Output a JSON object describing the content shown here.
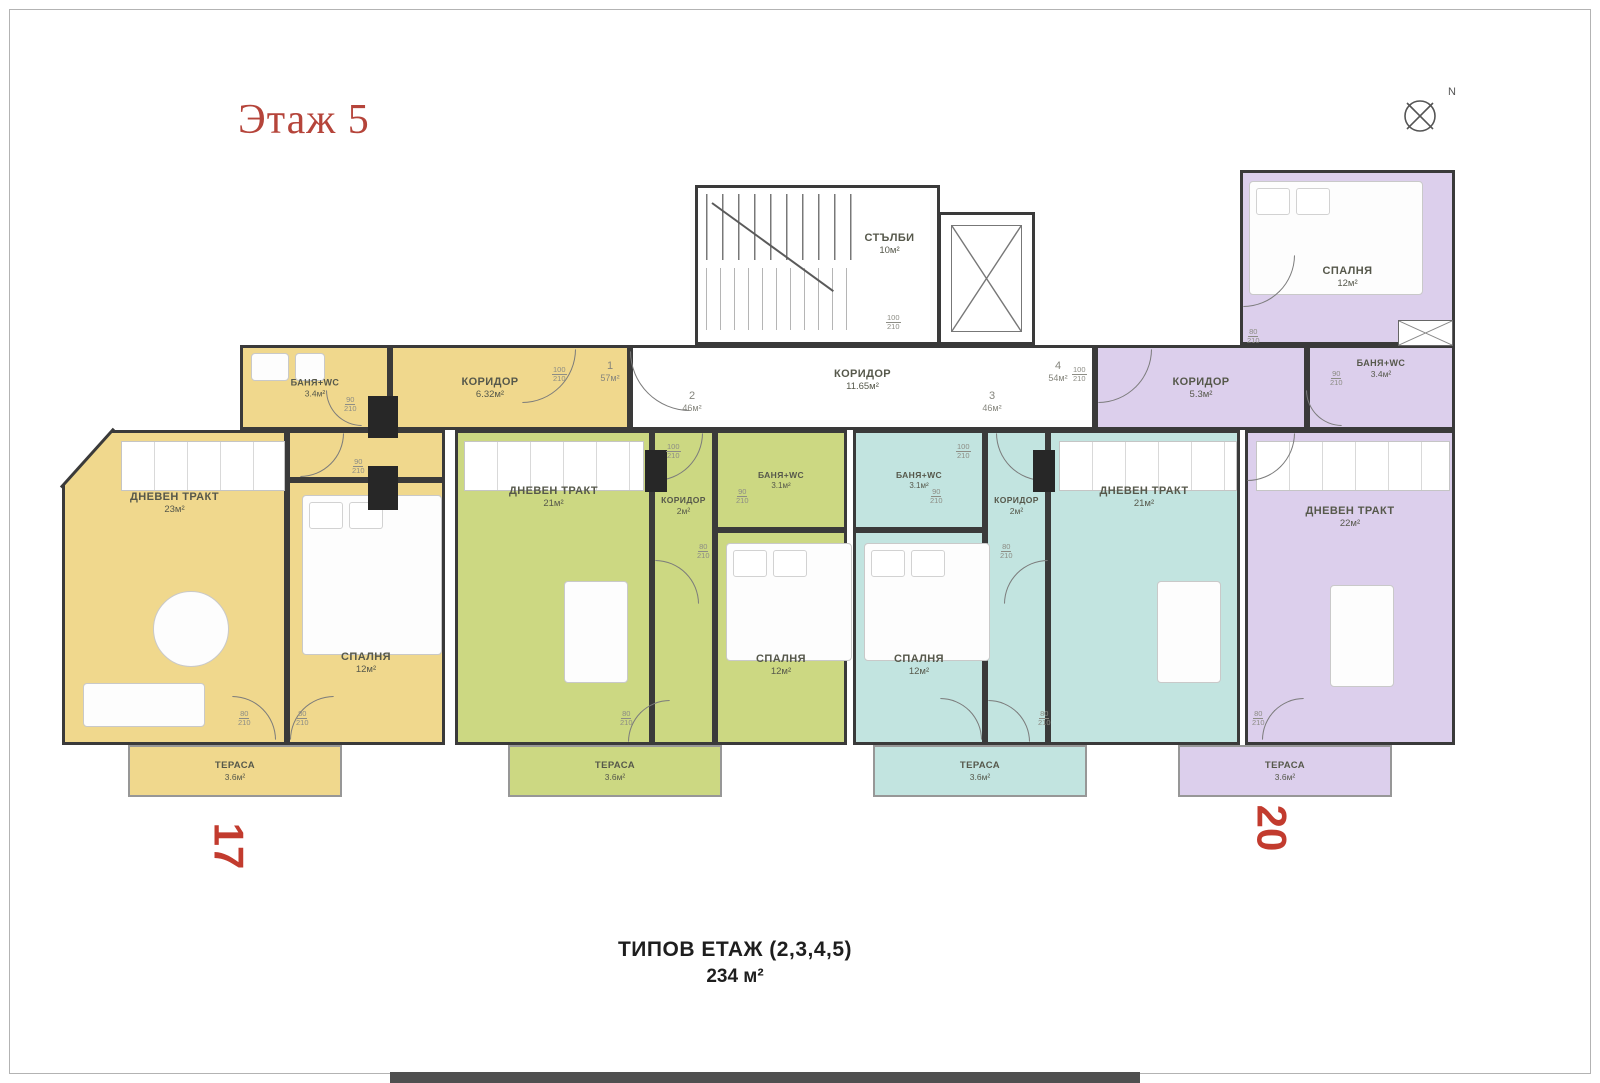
{
  "title": "Этаж 5",
  "north": {
    "label": "N"
  },
  "common": {
    "stairs": {
      "name": "СТЪЛБИ",
      "area": "10м²"
    },
    "corridor": {
      "name": "КОРИДОР",
      "area": "11.65м²"
    }
  },
  "apartments": {
    "apt1": {
      "number": "1",
      "total_area": "57м²",
      "plot_label": "17",
      "rooms": {
        "bath": {
          "name": "БАНЯ+WC",
          "area": "3.4м²"
        },
        "corridor": {
          "name": "КОРИДОР",
          "area": "6.32м²"
        },
        "living": {
          "name": "ДНЕВЕН ТРАКТ",
          "area": "23м²"
        },
        "bedroom": {
          "name": "СПАЛНЯ",
          "area": "12м²"
        },
        "terrace": {
          "name": "ТЕРАСА",
          "area": "3.6м²"
        }
      }
    },
    "apt2": {
      "number": "2",
      "total_area": "46м²",
      "rooms": {
        "living": {
          "name": "ДНЕВЕН ТРАКТ",
          "area": "21м²"
        },
        "corridor": {
          "name": "КОРИДОР",
          "area": "2м²"
        },
        "bath": {
          "name": "БАНЯ+WC",
          "area": "3.1м²"
        },
        "bedroom": {
          "name": "СПАЛНЯ",
          "area": "12м²"
        },
        "terrace": {
          "name": "ТЕРАСА",
          "area": "3.6м²"
        }
      }
    },
    "apt3": {
      "number": "3",
      "total_area": "46м²",
      "rooms": {
        "bath": {
          "name": "БАНЯ+WC",
          "area": "3.1м²"
        },
        "corridor": {
          "name": "КОРИДОР",
          "area": "2м²"
        },
        "living": {
          "name": "ДНЕВЕН ТРАКТ",
          "area": "21м²"
        },
        "bedroom": {
          "name": "СПАЛНЯ",
          "area": "12м²"
        },
        "terrace": {
          "name": "ТЕРАСА",
          "area": "3.6м²"
        }
      }
    },
    "apt4": {
      "number": "4",
      "total_area": "54м²",
      "plot_label": "20",
      "rooms": {
        "bedroom": {
          "name": "СПАЛНЯ",
          "area": "12м²"
        },
        "bath": {
          "name": "БАНЯ+WC",
          "area": "3.4м²"
        },
        "corridor": {
          "name": "КОРИДОР",
          "area": "5.3м²"
        },
        "living": {
          "name": "ДНЕВЕН ТРАКТ",
          "area": "22м²"
        },
        "terrace": {
          "name": "ТЕРАСА",
          "area": "3.6м²"
        }
      }
    }
  },
  "door_sizes": {
    "w100": "100",
    "w90": "90",
    "w80": "80",
    "h": "210"
  },
  "footer": {
    "line1": "ТИПОВ ЕТАЖ (2,3,4,5)",
    "line2": "234 м²"
  },
  "colors": {
    "apt1": "#f0d88d",
    "apt2": "#ccd882",
    "apt3": "#c2e4e0",
    "apt4": "#dccfec",
    "accent_red": "#b5443a",
    "number_red": "#c23b2e",
    "wall": "#3a3a3a"
  }
}
